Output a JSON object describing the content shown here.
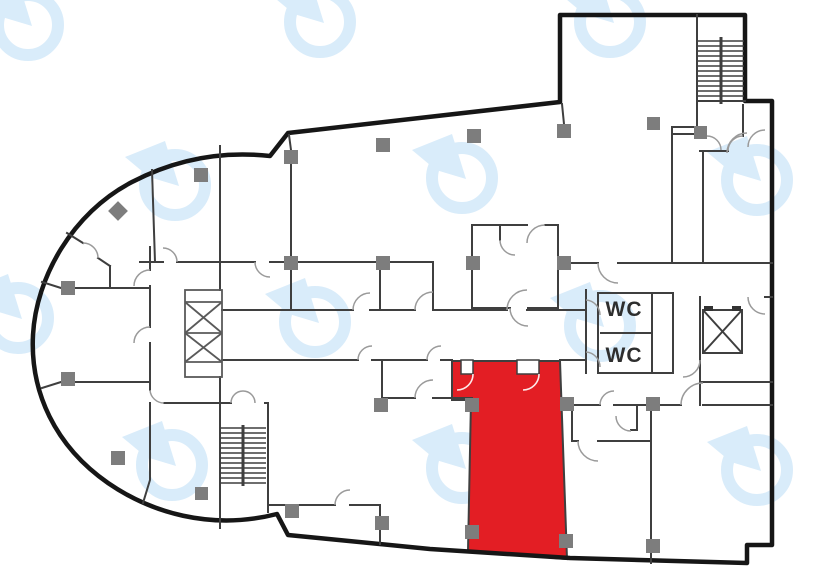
{
  "title": "Floor plan with highlighted unit",
  "labels": {
    "wc_top": "WC",
    "wc_bottom": "WC"
  },
  "colors": {
    "highlight_red": "#e31e24",
    "wall_dark": "#161616",
    "wall_gray": "#3f3f3f",
    "door_arc": "#9a9a9a",
    "marker_gray": "#7d7d7d",
    "watermark_blue": "#d9ecfa",
    "label_text": "#2e2e2e",
    "background": "#ffffff"
  },
  "symbols": {
    "stairs": "stairs-icon",
    "elevator": "elevator-icon",
    "column_marker": "column-marker-icon",
    "watermark": "circular-arrow-logo"
  }
}
